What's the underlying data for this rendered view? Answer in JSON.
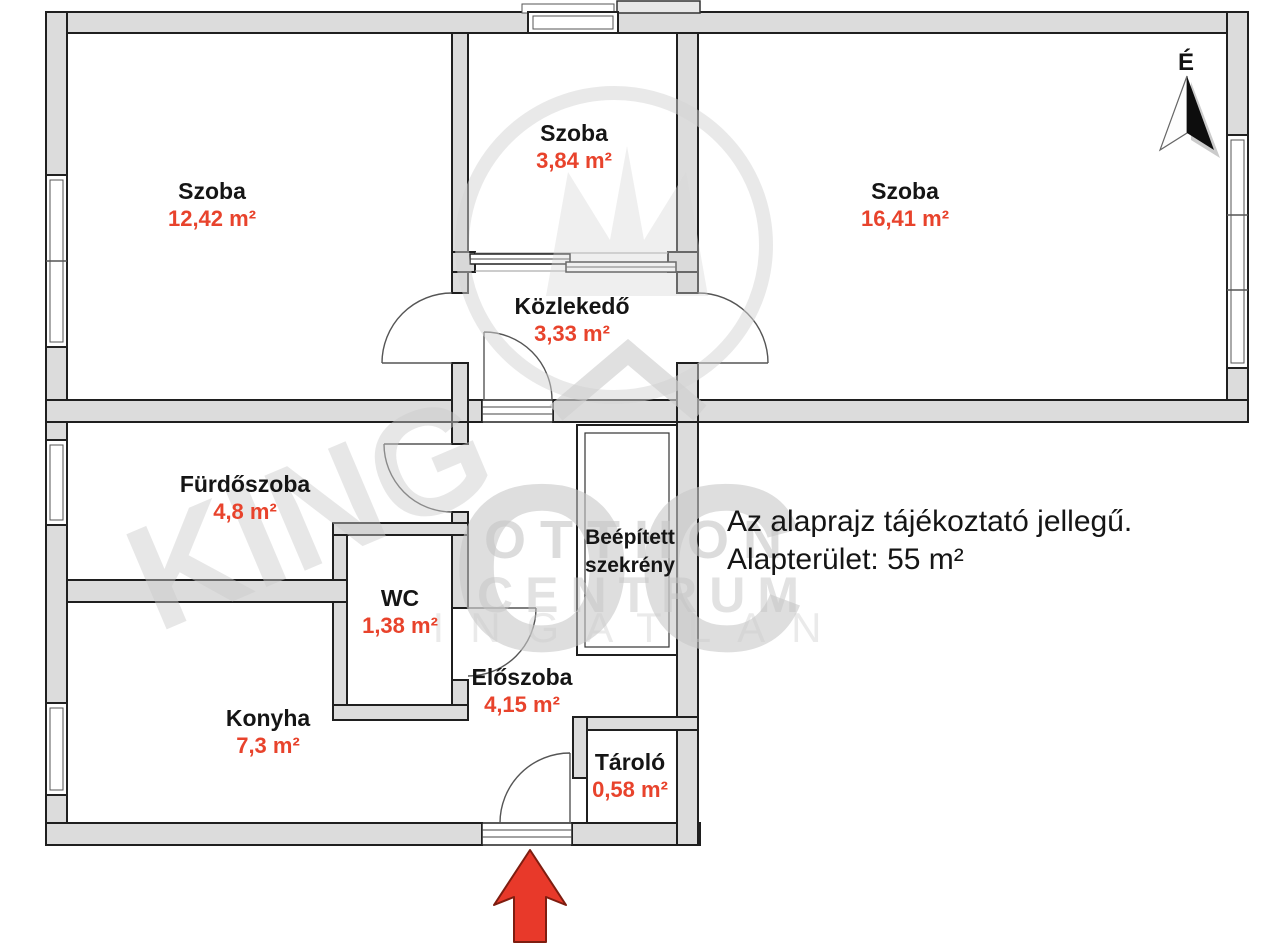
{
  "plan": {
    "rooms": [
      {
        "name": "Szoba",
        "area": "12,42 m²"
      },
      {
        "name": "Szoba",
        "area": "3,84 m²"
      },
      {
        "name": "Szoba",
        "area": "16,41 m²"
      },
      {
        "name": "Közlekedő",
        "area": "3,33 m²"
      },
      {
        "name": "Fürdőszoba",
        "area": "4,8 m²"
      },
      {
        "name": "WC",
        "area": "1,38 m²"
      },
      {
        "name_line1": "Beépített",
        "name_line2": "szekrény"
      },
      {
        "name": "Előszoba",
        "area": "4,15 m²"
      },
      {
        "name": "Konyha",
        "area": "7,3 m²"
      },
      {
        "name": "Tároló",
        "area": "0,58 m²"
      }
    ],
    "annotation": {
      "line1": "Az alaprajz tájékoztató jellegű.",
      "line2": "Alapterület: 55 m²"
    },
    "compass": {
      "label": "É"
    },
    "watermark": {
      "logo": "OC",
      "word1": "OTTHON",
      "word2": "CENTRUM",
      "word3": "INGATLAN",
      "diagonal": "KING"
    },
    "colors": {
      "area_value": "#e8432c",
      "label_text": "#151515",
      "wall_fill": "#dcdcdc",
      "wall_outline": "#1f1f1f",
      "entry_arrow": "#e8392a"
    }
  }
}
